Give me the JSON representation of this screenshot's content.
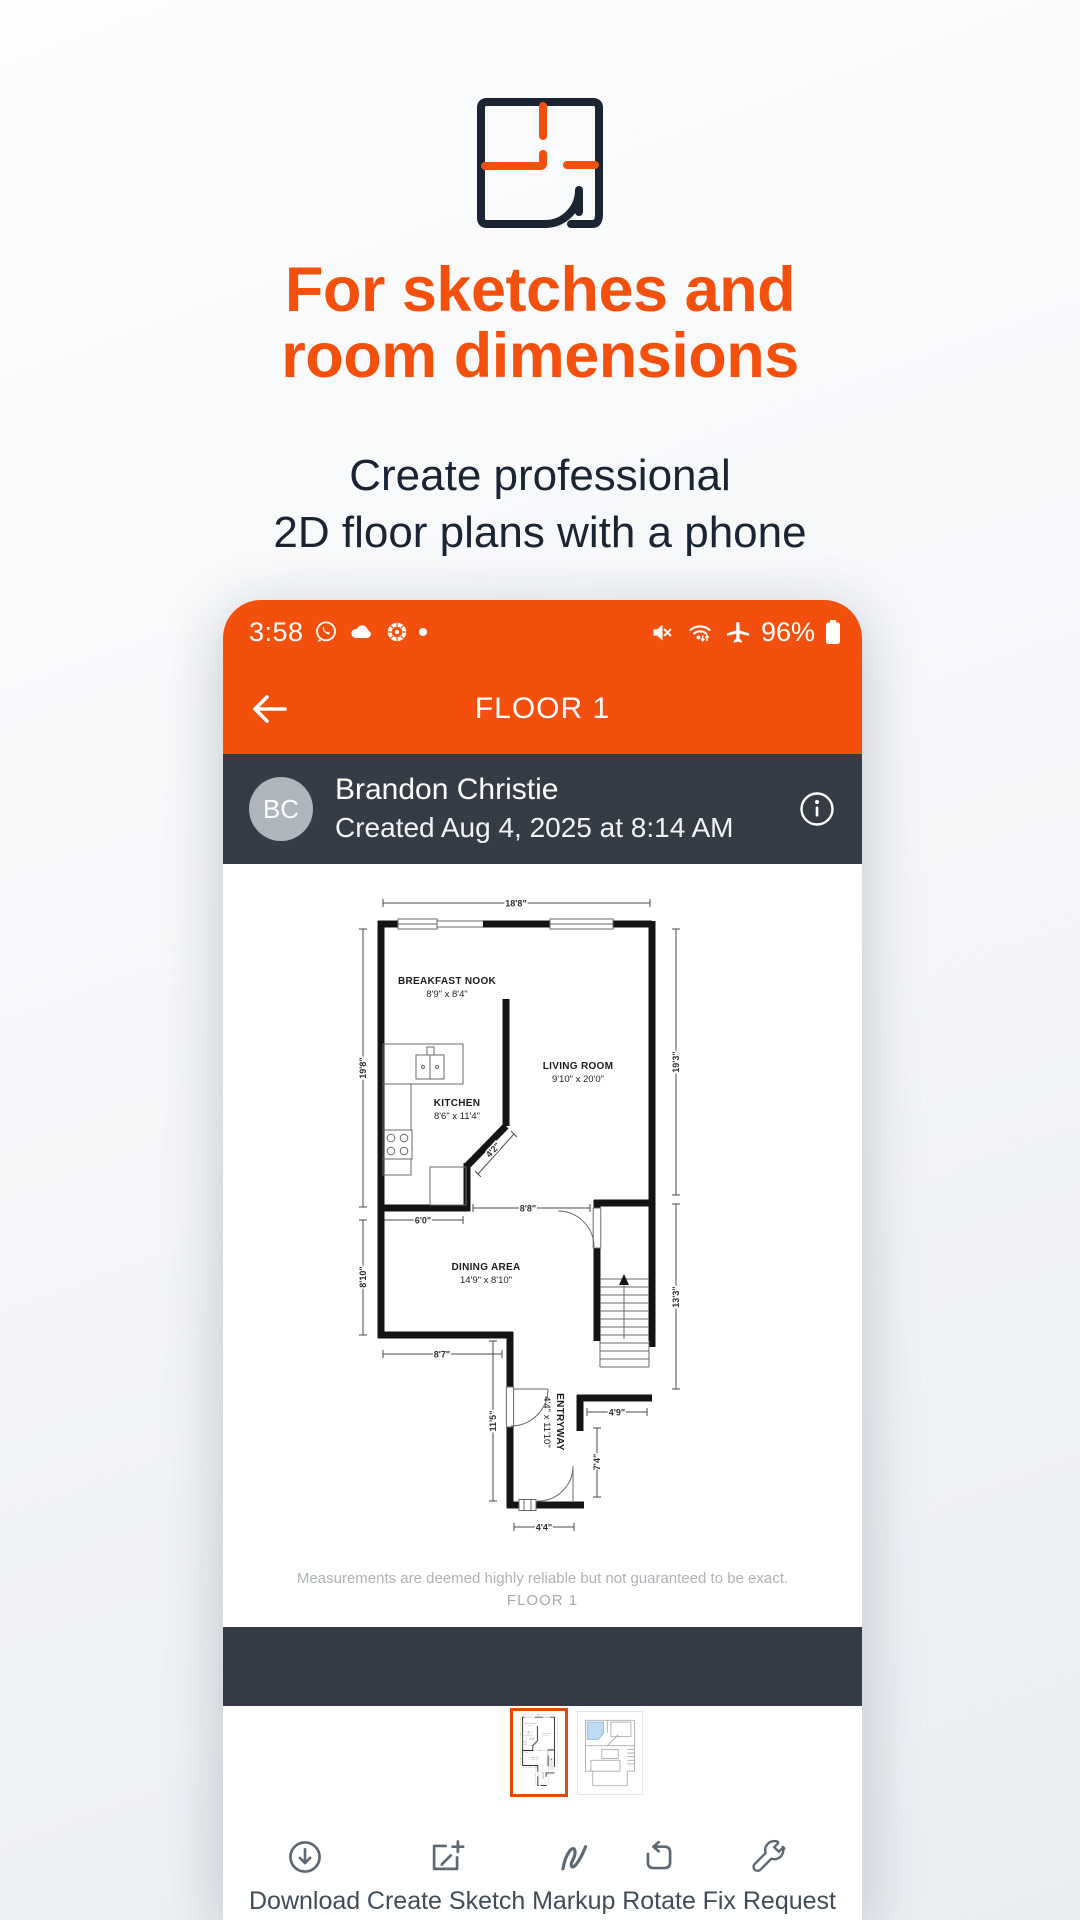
{
  "hero": {
    "icon": "floorplan-icon",
    "title1": "For sketches and",
    "title2": "room dimensions",
    "sub1": "Create professional",
    "sub2": "2D floor plans with a phone"
  },
  "colors": {
    "orange": "#F4500D",
    "navy": "#1B2433",
    "dark_bar": "#353C46",
    "avatar_bg": "#AEB5BC",
    "thumbnail_selected_border": "#E8470A",
    "thumbnail_highlight_room": "#BDDCF4"
  },
  "phone": {
    "status_bar": {
      "time": "3:58",
      "battery_percent": "96%",
      "left_icons": [
        "whatsapp-icon",
        "cloud-icon",
        "cbc-icon",
        "notification-dot"
      ],
      "right_icons": [
        "mute-icon",
        "wifi-icon",
        "airplane-icon",
        "battery-icon"
      ]
    },
    "app_bar": {
      "title": "FLOOR 1"
    },
    "user_bar": {
      "avatar_initials": "BC",
      "name": "Brandon Christie",
      "created": "Created Aug 4, 2025 at 8:14 AM"
    },
    "floorplan": {
      "rooms": [
        {
          "name": "BREAKFAST NOOK",
          "size": "8'9\" x 8'4\""
        },
        {
          "name": "LIVING ROOM",
          "size": "9'10\" x 20'0\""
        },
        {
          "name": "KITCHEN",
          "size": "8'6\" x 11'4\""
        },
        {
          "name": "DINING AREA",
          "size": "14'9\" x 8'10\""
        },
        {
          "name": "ENTRYWAY",
          "size": "4'4\" x 11'10\""
        }
      ],
      "dims": {
        "top": "18'8\"",
        "left_upper": "19'8\"",
        "right_upper": "19'3\"",
        "left_lower": "8'10\"",
        "right_lower": "13'3\"",
        "kitchen_pass": "6'0\"",
        "opening": "8'8\"",
        "diag": "4'2\"",
        "dining_bottom": "8'7\"",
        "entry_left": "11'5\"",
        "hall": "4'9\"",
        "hall_v": "7'4\"",
        "entry_bottom": "4'4\""
      },
      "disclaimer": "Measurements are deemed highly reliable but not guaranteed to be exact.",
      "floor_label": "FLOOR 1"
    },
    "toolbar": [
      {
        "label": "Download",
        "icon": "download-icon"
      },
      {
        "label": "Create Sketch",
        "icon": "create-sketch-icon"
      },
      {
        "label": "Markup",
        "icon": "markup-icon"
      },
      {
        "label": "Rotate",
        "icon": "rotate-icon"
      },
      {
        "label": "Fix Request",
        "icon": "fix-request-icon"
      }
    ]
  }
}
